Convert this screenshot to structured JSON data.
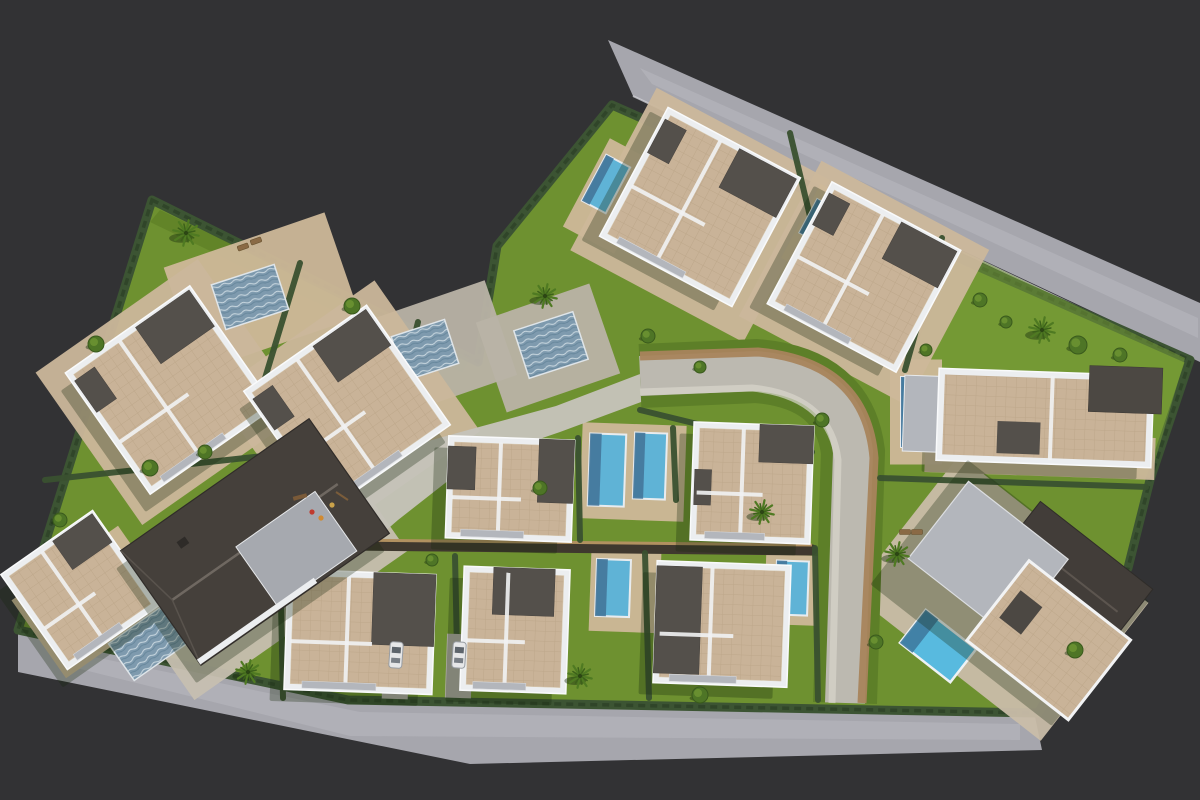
{
  "meta": {
    "description": "Aerial 3D render of a villa development site plan",
    "canvas": {
      "w": 1200,
      "h": 800
    }
  },
  "palette": {
    "background": "#323234",
    "road": "#a6a6ad",
    "road_streak": "#b8b8bf",
    "curb": "#d0d0d4",
    "lawn": "#6e9130",
    "lawn_dark": "#55751f",
    "hedge": "#3c5433",
    "hedge_dark": "#2f4428",
    "roof_tile": "#c9b398",
    "roof_tile_line": "#b39c7e",
    "parapet": "#eceef0",
    "roof_dark": "#54504b",
    "gable_roof": "#45403b",
    "wall_gray": "#b3b6bc",
    "patio_beige": "#cdb899",
    "patio_gray": "#b9b3a6",
    "plaza": "#c5c2b9",
    "street": "#bcb9b0",
    "street_band": "#a8845c",
    "pool_deep": "#44759a",
    "pool_bright": "#5fb3d6",
    "pool_ripple": "#7e9aae",
    "tree_green": "#4e7526",
    "palm_green": "#4f7a22",
    "car_body": "#e6e7e8",
    "lounger": "#8a6a45"
  },
  "scene": {
    "site": {
      "points": [
        [
          152,
          200
        ],
        [
          478,
          362
        ],
        [
          497,
          246
        ],
        [
          612,
          105
        ],
        [
          1190,
          360
        ],
        [
          1150,
          480
        ],
        [
          1128,
          568
        ],
        [
          1038,
          713
        ],
        [
          348,
          700
        ],
        [
          18,
          630
        ]
      ]
    },
    "roads": {
      "top": {
        "points": [
          [
            608,
            40
          ],
          [
            1200,
            303
          ],
          [
            1200,
            362
          ],
          [
            633,
            96
          ]
        ],
        "streak": [
          [
            640,
            68
          ],
          [
            1198,
            318
          ],
          [
            1198,
            338
          ],
          [
            652,
            84
          ]
        ],
        "curb": [
          [
            633,
            96
          ],
          [
            1186,
            358
          ]
        ]
      },
      "bottom": {
        "points": [
          [
            18,
            630
          ],
          [
            348,
            700
          ],
          [
            1034,
            712
          ],
          [
            1042,
            750
          ],
          [
            470,
            764
          ],
          [
            18,
            672
          ]
        ],
        "streak": [
          [
            60,
            650
          ],
          [
            360,
            712
          ],
          [
            1020,
            724
          ],
          [
            1020,
            740
          ],
          [
            350,
            736
          ],
          [
            60,
            664
          ]
        ],
        "curb": [
          [
            18,
            630
          ],
          [
            348,
            700
          ],
          [
            1034,
            712
          ]
        ]
      }
    },
    "street": {
      "verge_d": "M640 376 L756 371 Q844 378 853 452 L845 703",
      "main_d": "M640 376 L756 371 Q844 378 853 452 L845 703",
      "band_d": "M640 356 L758 352 Q866 362 874 458 L862 703",
      "walk_d": "M640 392 L752 388 Q830 396 838 460 L832 703"
    },
    "plaza": {
      "points": [
        [
          246,
          506
        ],
        [
          298,
          470
        ],
        [
          360,
          460
        ],
        [
          468,
          430
        ],
        [
          556,
          406
        ],
        [
          640,
          374
        ],
        [
          652,
          398
        ],
        [
          560,
          432
        ],
        [
          472,
          462
        ],
        [
          398,
          520
        ],
        [
          352,
          560
        ],
        [
          298,
          558
        ],
        [
          260,
          538
        ]
      ]
    },
    "lawn_tints": [
      {
        "points": [
          [
            960,
            250
          ],
          [
            1185,
            358
          ],
          [
            1150,
            478
          ],
          [
            905,
            370
          ]
        ],
        "color": "#7aa238",
        "opacity": 0.5
      },
      {
        "points": [
          [
            160,
            210
          ],
          [
            470,
            358
          ],
          [
            462,
            372
          ],
          [
            150,
            222
          ]
        ],
        "color": "#55751f",
        "opacity": 0.45
      }
    ],
    "pads": [
      [
        262,
        292,
        170,
        110,
        -19,
        "#cdb899"
      ],
      [
        430,
        352,
        150,
        100,
        -19,
        "#b9b3a6"
      ],
      [
        548,
        348,
        120,
        95,
        -19,
        "#b9b3a6"
      ],
      [
        700,
        215,
        196,
        184,
        28,
        "#cbb79b"
      ],
      [
        864,
        283,
        190,
        176,
        28,
        "#cbb79b"
      ],
      [
        170,
        392,
        198,
        186,
        -35,
        "#cbb79b"
      ],
      [
        347,
        412,
        196,
        184,
        -35,
        "#cbb79b"
      ],
      [
        92,
        602,
        130,
        95,
        -35,
        "#cdb899"
      ],
      [
        255,
        560,
        260,
        160,
        -35,
        "#c6bfb0"
      ],
      [
        1000,
        598,
        240,
        175,
        38,
        "#c9bda9"
      ],
      [
        916,
        412,
        52,
        105,
        0,
        "#cdb899"
      ],
      [
        1040,
        455,
        230,
        42,
        2,
        "#cbb79b"
      ],
      [
        633,
        472,
        104,
        96,
        2,
        "#cdb899"
      ],
      [
        625,
        592,
        70,
        80,
        2,
        "#cdb899"
      ],
      [
        792,
        590,
        54,
        70,
        2,
        "#cdb899"
      ],
      [
        282,
        570,
        70,
        36,
        2,
        "#cdb899"
      ],
      [
        612,
        196,
        58,
        100,
        28,
        "#cdb899"
      ],
      [
        822,
        232,
        48,
        84,
        28,
        "#cdb899"
      ]
    ],
    "wall": {
      "x1": 345,
      "y1": 545,
      "x2": 812,
      "y2": 550
    },
    "hedges": [
      [
        300,
        263,
        262,
        388
      ],
      [
        418,
        322,
        388,
        444
      ],
      [
        45,
        480,
        300,
        452
      ],
      [
        790,
        133,
        838,
        333
      ],
      [
        942,
        238,
        905,
        370
      ],
      [
        578,
        438,
        580,
        540
      ],
      [
        673,
        428,
        676,
        500
      ],
      [
        280,
        556,
        283,
        698
      ],
      [
        455,
        556,
        458,
        698
      ],
      [
        645,
        553,
        649,
        698
      ],
      [
        815,
        548,
        818,
        700
      ],
      [
        880,
        478,
        1146,
        487
      ],
      [
        640,
        410,
        812,
        452
      ]
    ],
    "driveways": [
      [
        396,
        662,
        26,
        74,
        2
      ],
      [
        459,
        666,
        26,
        64,
        2
      ]
    ],
    "pools": [
      {
        "name": "pool-ripple-1",
        "cx": 250,
        "cy": 297,
        "w": 66,
        "h": 47,
        "rot": -18,
        "type": "ripple"
      },
      {
        "name": "pool-ripple-2",
        "cx": 425,
        "cy": 350,
        "w": 56,
        "h": 46,
        "rot": -18,
        "type": "ripple"
      },
      {
        "name": "pool-ripple-3",
        "cx": 551,
        "cy": 345,
        "w": 62,
        "h": 50,
        "rot": -18,
        "type": "ripple"
      },
      {
        "name": "pool-ripple-4",
        "cx": 150,
        "cy": 642,
        "w": 70,
        "h": 45,
        "rot": -35,
        "type": "ripple"
      },
      {
        "name": "pool-top-1",
        "cx": 606,
        "cy": 184,
        "w": 27,
        "h": 52,
        "rot": 28,
        "type": "plain"
      },
      {
        "name": "pool-top-2",
        "cx": 818,
        "cy": 221,
        "w": 22,
        "h": 38,
        "rot": 28,
        "type": "plain"
      },
      {
        "name": "pool-right-1",
        "cx": 916,
        "cy": 412,
        "w": 30,
        "h": 70,
        "rot": 0,
        "type": "plain"
      },
      {
        "name": "pool-central-1",
        "cx": 607,
        "cy": 470,
        "w": 36,
        "h": 72,
        "rot": 2,
        "type": "plain"
      },
      {
        "name": "pool-central-2",
        "cx": 650,
        "cy": 466,
        "w": 32,
        "h": 66,
        "rot": 2,
        "type": "plain"
      },
      {
        "name": "pool-bottom-1",
        "cx": 291,
        "cy": 571,
        "w": 30,
        "h": 28,
        "rot": 2,
        "type": "plain"
      },
      {
        "name": "pool-bottom-2",
        "cx": 613,
        "cy": 588,
        "w": 34,
        "h": 57,
        "rot": 2,
        "type": "plain"
      },
      {
        "name": "pool-bottom-3",
        "cx": 792,
        "cy": 588,
        "w": 32,
        "h": 54,
        "rot": 2,
        "type": "plain"
      },
      {
        "name": "pool-corner",
        "cx": 938,
        "cy": 646,
        "w": 64,
        "h": 42,
        "rot": 38,
        "type": "bright"
      }
    ],
    "villas": [
      {
        "name": "villa-top-1",
        "cx": 700,
        "cy": 207,
        "w": 150,
        "h": 146,
        "rot": 28,
        "variant": "std",
        "dark": [
          [
            0.55,
            0.02,
            0.43,
            0.3
          ],
          [
            0.02,
            0.08,
            0.16,
            0.26
          ]
        ]
      },
      {
        "name": "villa-top-2",
        "cx": 864,
        "cy": 277,
        "w": 146,
        "h": 138,
        "rot": 28,
        "variant": "std",
        "dark": [
          [
            0.55,
            0.02,
            0.43,
            0.3
          ],
          [
            0.02,
            0.08,
            0.16,
            0.26
          ]
        ]
      },
      {
        "name": "villa-left-1",
        "cx": 170,
        "cy": 390,
        "w": 152,
        "h": 148,
        "rot": -35,
        "variant": "std",
        "dark": [
          [
            0.55,
            0.02,
            0.43,
            0.3
          ],
          [
            0.02,
            0.08,
            0.16,
            0.26
          ]
        ]
      },
      {
        "name": "villa-left-2",
        "cx": 347,
        "cy": 408,
        "w": 150,
        "h": 146,
        "rot": -35,
        "variant": "std",
        "dark": [
          [
            0.55,
            0.02,
            0.43,
            0.3
          ],
          [
            0.02,
            0.08,
            0.16,
            0.26
          ]
        ]
      },
      {
        "name": "villa-central-1",
        "cx": 510,
        "cy": 489,
        "w": 126,
        "h": 102,
        "rot": 2,
        "variant": "std",
        "dark": [
          [
            0.72,
            0.0,
            0.28,
            0.62
          ],
          [
            0.0,
            0.1,
            0.22,
            0.42
          ]
        ]
      },
      {
        "name": "villa-central-2",
        "cx": 752,
        "cy": 483,
        "w": 120,
        "h": 118,
        "rot": 2,
        "variant": "std",
        "dark": [
          [
            0.55,
            0.0,
            0.45,
            0.32
          ],
          [
            0.02,
            0.4,
            0.14,
            0.3
          ]
        ]
      },
      {
        "name": "villa-bottom-1",
        "cx": 360,
        "cy": 632,
        "w": 148,
        "h": 120,
        "rot": 2,
        "variant": "std",
        "dark": [
          [
            0.58,
            0.0,
            0.42,
            0.6
          ]
        ]
      },
      {
        "name": "villa-bottom-2",
        "cx": 515,
        "cy": 630,
        "w": 106,
        "h": 124,
        "rot": 2,
        "variant": "std",
        "dark": [
          [
            0.28,
            0.0,
            0.58,
            0.38
          ]
        ]
      },
      {
        "name": "villa-bottom-3",
        "cx": 722,
        "cy": 624,
        "w": 134,
        "h": 122,
        "rot": 2,
        "variant": "std",
        "dark": [
          [
            0.0,
            0.04,
            0.34,
            0.88
          ]
        ]
      },
      {
        "name": "villa-right-terrace",
        "cx": 1045,
        "cy": 418,
        "w": 215,
        "h": 92,
        "rot": 2,
        "variant": "terrace",
        "dark": []
      },
      {
        "name": "villa-corner-small",
        "cx": 80,
        "cy": 590,
        "w": 112,
        "h": 116,
        "rot": -35,
        "variant": "std",
        "dark": [
          [
            0.55,
            0.02,
            0.43,
            0.3
          ]
        ]
      },
      {
        "name": "villa-gable-dark",
        "cx": 255,
        "cy": 542,
        "w": 230,
        "h": 140,
        "rot": -35,
        "variant": "gable",
        "dark": []
      },
      {
        "name": "villa-rotated-mixed",
        "cx": 1028,
        "cy": 592,
        "w": 230,
        "h": 158,
        "rot": 38,
        "variant": "mixed",
        "dark": []
      }
    ],
    "cars": [
      [
        396,
        655,
        4
      ],
      [
        459,
        655,
        4
      ]
    ],
    "loungers": [
      [
        243,
        247,
        -20
      ],
      [
        256,
        241,
        -20
      ],
      [
        905,
        532,
        0
      ],
      [
        917,
        532,
        0
      ]
    ],
    "playground": {
      "bench": {
        "cx": 300,
        "cy": 497,
        "rot": -15
      },
      "dots": [
        [
          312,
          512,
          "#c03b2e"
        ],
        [
          321,
          518,
          "#d08a32"
        ],
        [
          332,
          505,
          "#caa24a"
        ]
      ],
      "frame": [
        336,
        492,
        348,
        500
      ]
    },
    "trees": [
      [
        186,
        233,
        13,
        "palm"
      ],
      [
        545,
        296,
        12,
        "palm"
      ],
      [
        762,
        512,
        12,
        "palm"
      ],
      [
        897,
        554,
        12,
        "palm"
      ],
      [
        1042,
        330,
        13,
        "palm"
      ],
      [
        580,
        676,
        12,
        "palm"
      ],
      [
        248,
        672,
        12,
        "palm"
      ],
      [
        96,
        344,
        8,
        "bush"
      ],
      [
        352,
        306,
        8,
        "bush"
      ],
      [
        648,
        336,
        7,
        "bush"
      ],
      [
        700,
        367,
        6,
        "bush"
      ],
      [
        540,
        488,
        7,
        "bush"
      ],
      [
        150,
        468,
        8,
        "bush"
      ],
      [
        205,
        452,
        7,
        "bush"
      ],
      [
        876,
        642,
        7,
        "bush"
      ],
      [
        1075,
        650,
        8,
        "bush"
      ],
      [
        822,
        420,
        7,
        "bush"
      ],
      [
        60,
        520,
        7,
        "bush"
      ],
      [
        926,
        350,
        6,
        "bush"
      ],
      [
        1120,
        355,
        7,
        "bush"
      ],
      [
        980,
        300,
        7,
        "bush"
      ],
      [
        1006,
        322,
        6,
        "bush"
      ],
      [
        1078,
        345,
        9,
        "bush"
      ],
      [
        700,
        695,
        8,
        "bush"
      ],
      [
        432,
        560,
        6,
        "bush"
      ]
    ]
  }
}
